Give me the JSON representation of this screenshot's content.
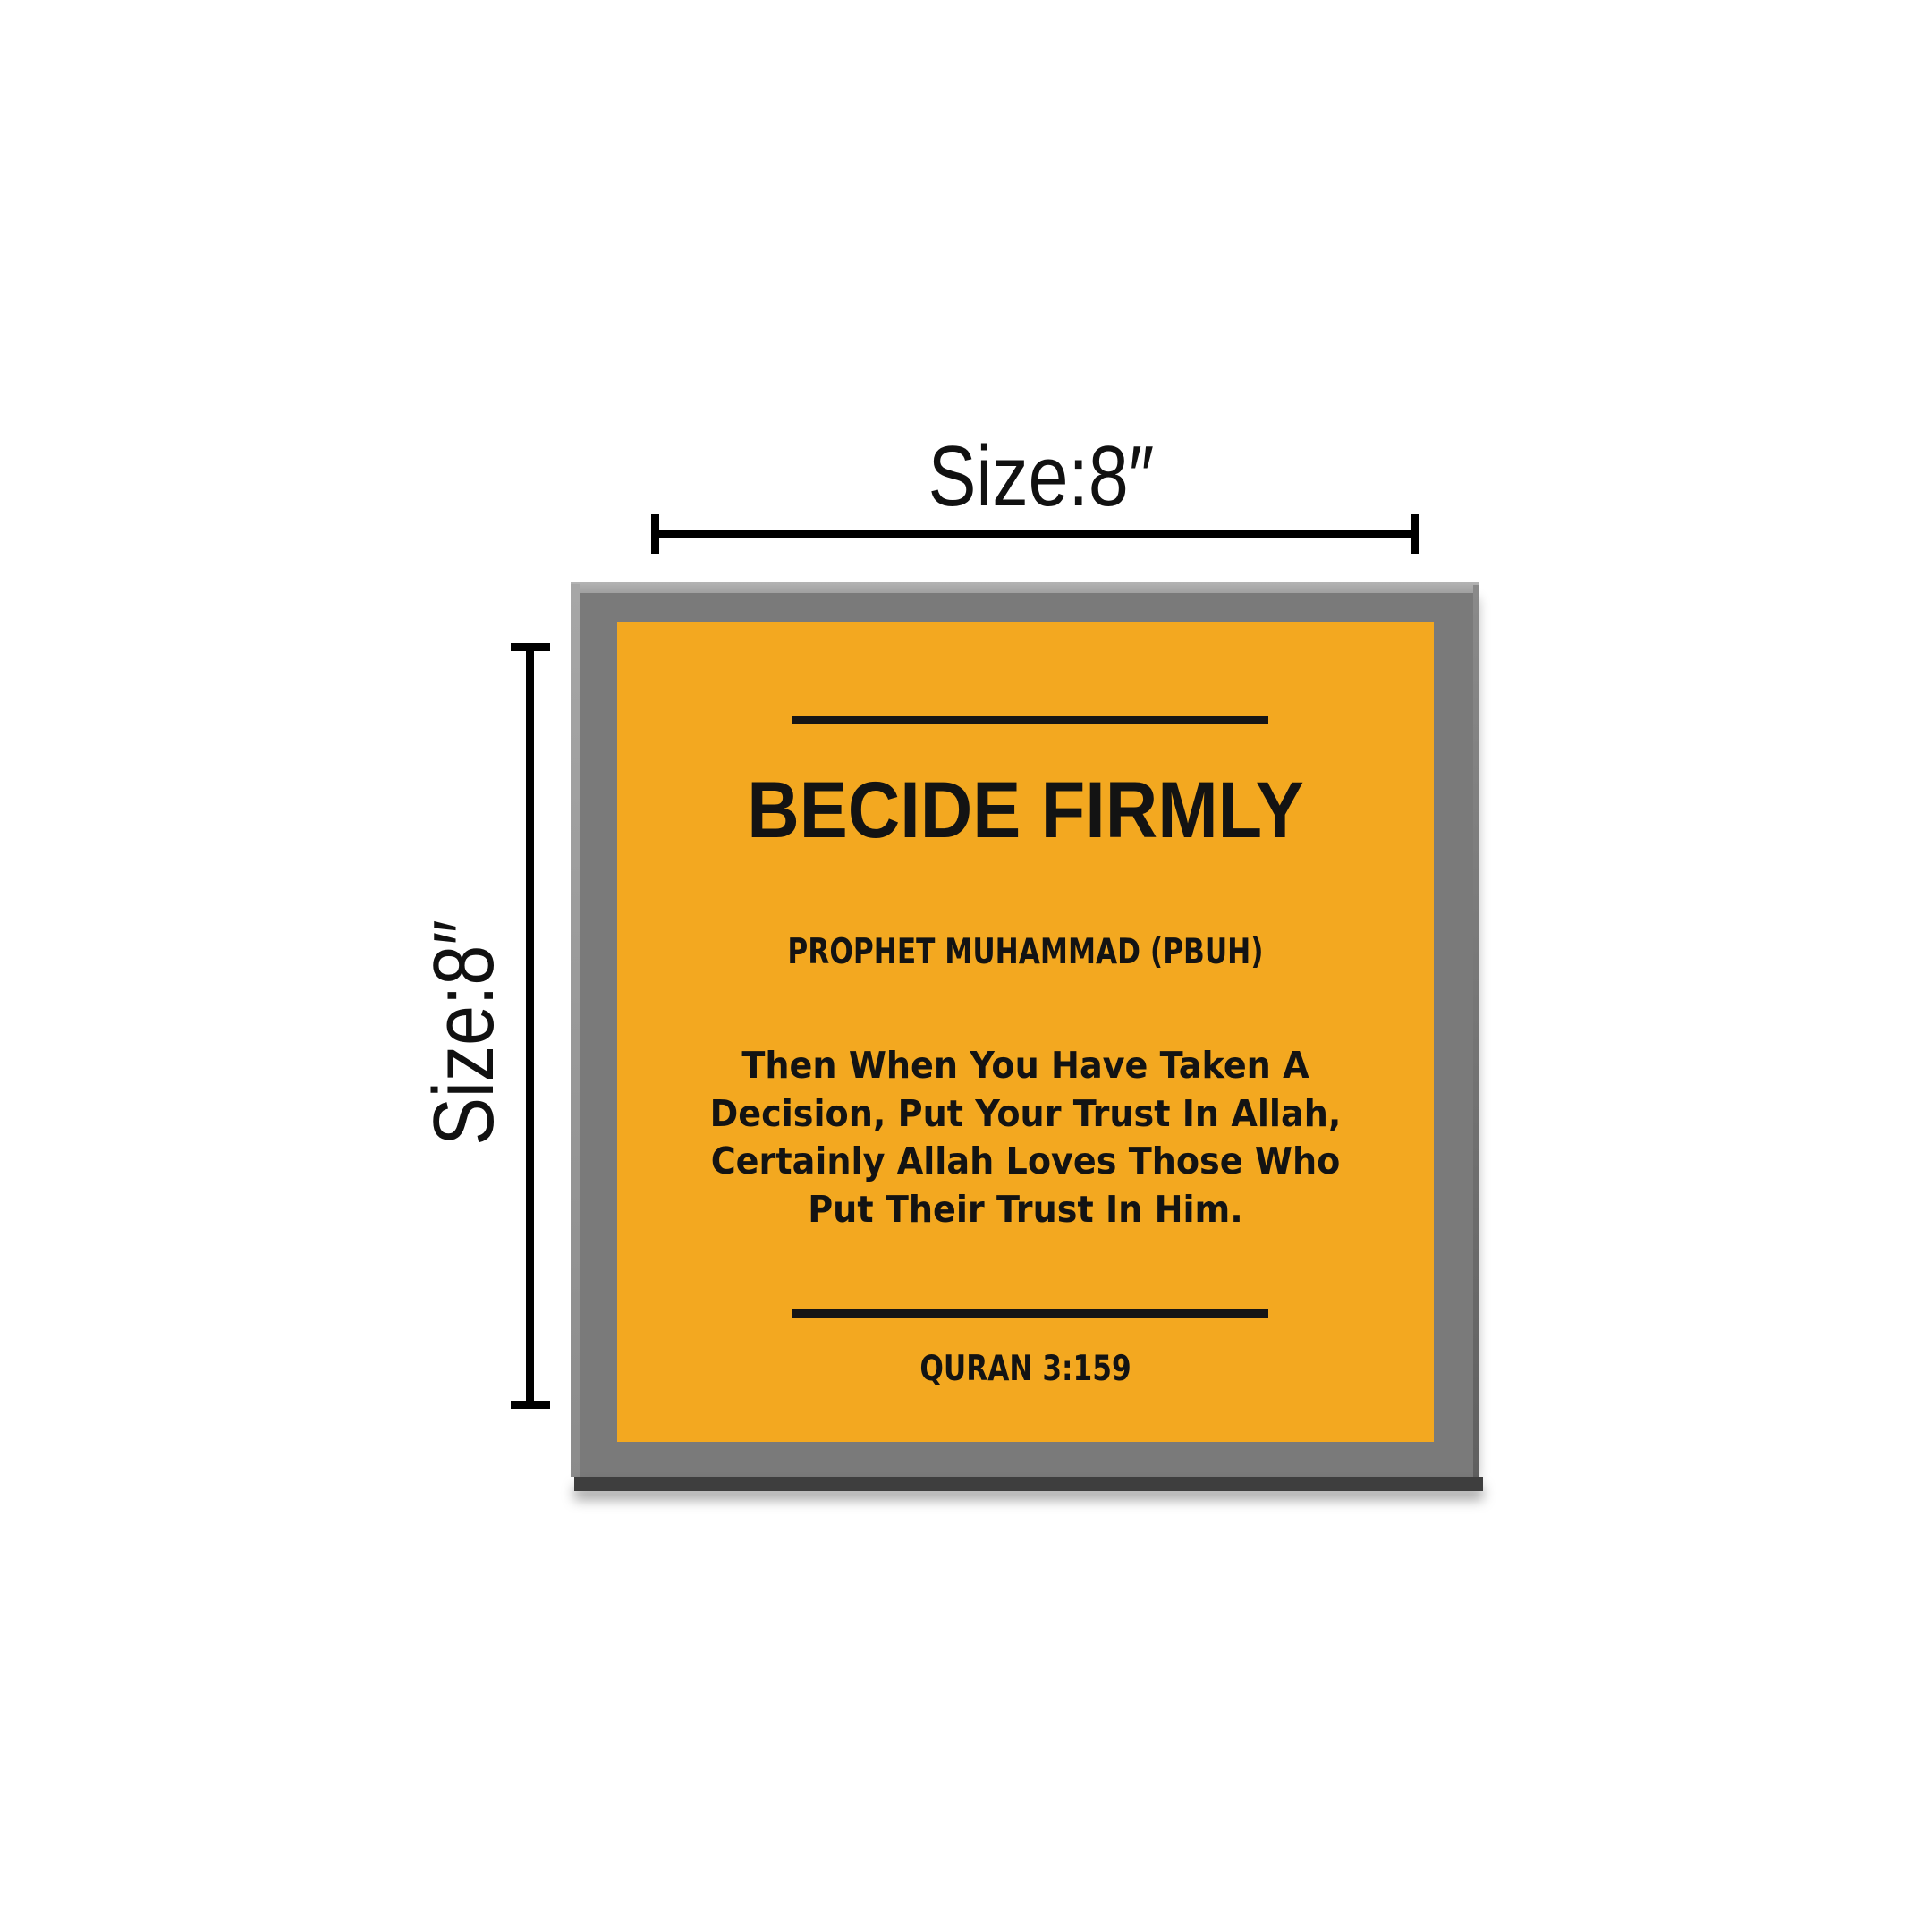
{
  "size_labels": {
    "top": "Size:8″",
    "left": "Size:8″"
  },
  "plaque": {
    "title": "BECIDE FIRMLY",
    "attribution": "PROPHET MUHAMMAD (PBUH)",
    "quote_lines": [
      "Then When You Have Taken A",
      "Decision, Put Your Trust In Allah,",
      "Certainly Allah Loves Those Who",
      "Put Their Trust In Him."
    ],
    "reference": "QURAN 3:159"
  },
  "colors": {
    "background": "#ffffff",
    "frame": "#7a7a7a",
    "frame_highlight": "#b4b4b4",
    "frame_bevel_left": "#a6a6a6",
    "frame_edge_right": "#606060",
    "frame_edge_dark": "#3e3e3e",
    "art_background": "#f3a820",
    "art_text": "#131313",
    "dimension": "#000000"
  }
}
